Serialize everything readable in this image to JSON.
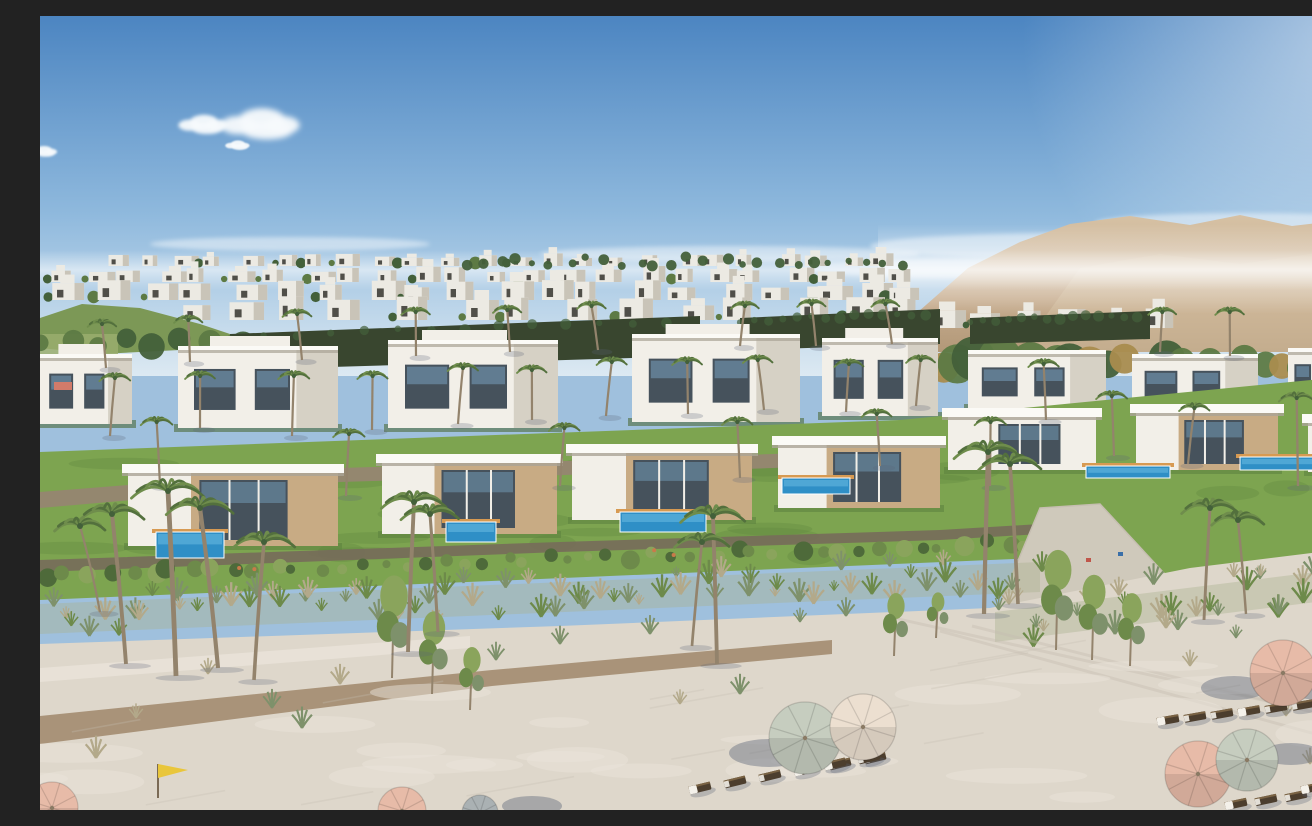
{
  "meta": {
    "description": "Aerial architectural rendering of a beachfront resort community: terraced rows of modern white villas with private blue pools and palm trees, desert mountains on the right horizon, a dune grass strip, and a wide sandy beach with pink and sage umbrellas, wooden sun loungers and a yellow beach flag.",
    "width": 1312,
    "height": 794
  },
  "palette": {
    "skyTop": "#4c85c1",
    "skyMid": "#8fb9dd",
    "skyHorizon": "#dce9f2",
    "cloud": "#f7fafc",
    "mountain": "#c8ae90",
    "mountainShade": "#b29878",
    "mountainLight": "#d6c1a4",
    "hillGreen": "#7c9856",
    "fieldGreen": "#9aad6d",
    "houseLight": "#eceae3",
    "houseShade": "#c9c4b8",
    "houseWindow": "#504f49",
    "treeGreen": "#5d7a44",
    "treeDark": "#43603a",
    "treeAutumn": "#a98c4e",
    "hedgeDark": "#39462f",
    "villaWhite": "#f2efe8",
    "villaShade": "#d6d1c5",
    "roofWhite": "#fbfaf6",
    "roofShadow": "#aaa496",
    "wood": "#c8ab84",
    "glass": "#46525c",
    "glassBlue": "#7ba6c6",
    "poolBlue": "#2f8fc6",
    "poolLight": "#5db0dc",
    "deckOrange": "#d79a52",
    "lawn": "#7da450",
    "lawnDark": "#5d8440",
    "shrub": "#4e6a3a",
    "shrubLight": "#6d8a4a",
    "shrubPale": "#8aa45c",
    "flower": "#c97a4a",
    "stone": "#94876f",
    "stoneDark": "#776c5a",
    "concrete": "#cfc9bb",
    "sand": "#ded7cb",
    "sandLight": "#eae4da",
    "sandShade": "#c6beb1",
    "dirt": "#a28a6d",
    "duneSage": "#a9b18e",
    "tuftGreen": "#7e916b",
    "tuftDry": "#b3a98a",
    "palmTrunk": "#93836c",
    "palmFrond": "#53703d",
    "palmFrondLight": "#6f8d4c",
    "umbrellaPink": "#e7bba8",
    "umbrellaCream": "#ecdfd0",
    "umbrellaSage": "#c6cdbf",
    "umbrellaGray": "#aab1b3",
    "shadowBlue": "#5a6478",
    "loungerDark": "#4c3e2e",
    "loungerFrame": "#7a6344",
    "towelWhite": "#f4f1ea",
    "flagYellow": "#e9c63b"
  },
  "sky": {
    "clouds": [
      {
        "x": 164,
        "y": 106,
        "s": 0.8
      },
      {
        "x": 222,
        "y": 104,
        "s": 1.3
      },
      {
        "x": 198,
        "y": 128,
        "s": 0.4
      },
      {
        "x": 4,
        "y": 134,
        "s": 0.45
      }
    ],
    "wisps": [
      {
        "x": 250,
        "y": 228,
        "rx": 140,
        "ry": 7
      },
      {
        "x": 690,
        "y": 238,
        "rx": 190,
        "ry": 8
      },
      {
        "x": 1040,
        "y": 230,
        "rx": 210,
        "ry": 13
      },
      {
        "x": 1205,
        "y": 207,
        "rx": 150,
        "ry": 10
      },
      {
        "x": 930,
        "y": 252,
        "rx": 170,
        "ry": 10
      }
    ]
  },
  "mountains": {
    "main": [
      [
        838,
        336
      ],
      [
        878,
        296
      ],
      [
        928,
        252
      ],
      [
        980,
        226
      ],
      [
        1030,
        208
      ],
      [
        1090,
        200
      ],
      [
        1150,
        209
      ],
      [
        1200,
        199
      ],
      [
        1252,
        210
      ],
      [
        1312,
        203
      ],
      [
        1312,
        336
      ]
    ],
    "front": [
      [
        980,
        336
      ],
      [
        1040,
        252
      ],
      [
        1120,
        238
      ],
      [
        1200,
        248
      ],
      [
        1312,
        232
      ],
      [
        1312,
        336
      ]
    ]
  },
  "farHills": {
    "green": [
      [
        0,
        302
      ],
      [
        42,
        288
      ],
      [
        100,
        292
      ],
      [
        160,
        308
      ],
      [
        202,
        322
      ],
      [
        140,
        334
      ],
      [
        60,
        338
      ],
      [
        0,
        332
      ]
    ],
    "field": {
      "x": 0,
      "y": 318,
      "w": 78,
      "h": 44
    }
  },
  "distantRows": [
    {
      "y": 250,
      "x0": 60,
      "x1": 860,
      "n": 24,
      "wMin": 14,
      "wMax": 26,
      "hMin": 8,
      "hMax": 13,
      "treeProb": 0.45,
      "seed": 11
    },
    {
      "y": 266,
      "x0": 0,
      "x1": 880,
      "n": 24,
      "wMin": 16,
      "wMax": 30,
      "hMin": 10,
      "hMax": 16,
      "treeProb": 0.4,
      "seed": 22
    },
    {
      "y": 284,
      "x0": 0,
      "x1": 890,
      "n": 20,
      "wMin": 20,
      "wMax": 36,
      "hMin": 12,
      "hMax": 20,
      "treeProb": 0.4,
      "seed": 33
    },
    {
      "y": 304,
      "x0": 120,
      "x1": 900,
      "n": 14,
      "wMin": 24,
      "wMax": 44,
      "hMin": 14,
      "hMax": 24,
      "treeProb": 0.5,
      "seed": 44
    },
    {
      "y": 312,
      "x0": 880,
      "x1": 1150,
      "n": 6,
      "wMin": 22,
      "wMax": 38,
      "hMin": 12,
      "hMax": 20,
      "treeProb": 0.6,
      "seed": 55
    }
  ],
  "treelines": [
    {
      "y": 250,
      "x0": 420,
      "x1": 870,
      "n": 26,
      "rMin": 3,
      "rMax": 6,
      "seed": 5,
      "color": "treeDark",
      "autumn": 0
    },
    {
      "y": 352,
      "x0": 855,
      "x1": 1312,
      "n": 24,
      "rMin": 11,
      "rMax": 22,
      "seed": 6,
      "color": "treeGreen",
      "autumn": 0.25
    },
    {
      "y": 332,
      "x0": 0,
      "x1": 215,
      "n": 8,
      "rMin": 8,
      "rMax": 14,
      "seed": 7,
      "color": "treeGreen",
      "autumn": 0
    }
  ],
  "hedges": [
    {
      "pts": [
        [
          190,
          318
        ],
        [
          660,
          300
        ],
        [
          660,
          340
        ],
        [
          190,
          354
        ]
      ]
    },
    {
      "pts": [
        [
          700,
          302
        ],
        [
          900,
          293
        ],
        [
          900,
          328
        ],
        [
          700,
          334
        ]
      ]
    },
    {
      "pts": [
        [
          930,
          302
        ],
        [
          1110,
          295
        ],
        [
          1110,
          323
        ],
        [
          930,
          328
        ]
      ]
    }
  ],
  "backVillas": [
    {
      "x": 0,
      "y": 338,
      "w": 92,
      "h": 70,
      "two": true
    },
    {
      "x": 138,
      "y": 330,
      "w": 160,
      "h": 82,
      "two": true
    },
    {
      "x": 348,
      "y": 324,
      "w": 170,
      "h": 88,
      "two": true
    },
    {
      "x": 592,
      "y": 318,
      "w": 168,
      "h": 88,
      "two": true
    },
    {
      "x": 782,
      "y": 322,
      "w": 116,
      "h": 78,
      "two": true
    },
    {
      "x": 928,
      "y": 334,
      "w": 138,
      "h": 58,
      "two": false
    },
    {
      "x": 1092,
      "y": 338,
      "w": 126,
      "h": 56,
      "two": false
    },
    {
      "x": 1248,
      "y": 332,
      "w": 64,
      "h": 54,
      "two": false
    }
  ],
  "lawn": {
    "main": [
      [
        0,
        436
      ],
      [
        860,
        404
      ],
      [
        1312,
        360
      ],
      [
        1312,
        548
      ],
      [
        1150,
        564
      ],
      [
        1046,
        540
      ],
      [
        0,
        584
      ]
    ],
    "wall1": [
      [
        0,
        476
      ],
      [
        300,
        452
      ],
      [
        620,
        442
      ],
      [
        900,
        432
      ],
      [
        900,
        446
      ],
      [
        620,
        456
      ],
      [
        300,
        466
      ],
      [
        0,
        492
      ]
    ],
    "wall2": [
      [
        0,
        544
      ],
      [
        520,
        526
      ],
      [
        900,
        514
      ],
      [
        1000,
        508
      ],
      [
        1000,
        518
      ],
      [
        900,
        524
      ],
      [
        520,
        536
      ],
      [
        0,
        556
      ]
    ]
  },
  "frontVillas": [
    {
      "x": 88,
      "y": 448,
      "w": 210,
      "h": 82,
      "wood": true
    },
    {
      "x": 342,
      "y": 438,
      "w": 175,
      "h": 80,
      "wood": true
    },
    {
      "x": 532,
      "y": 428,
      "w": 180,
      "h": 76,
      "wood": true
    },
    {
      "x": 738,
      "y": 420,
      "w": 162,
      "h": 72,
      "wood": true
    },
    {
      "x": 908,
      "y": 392,
      "w": 148,
      "h": 62,
      "wood": false
    },
    {
      "x": 1096,
      "y": 388,
      "w": 142,
      "h": 66,
      "wood": true
    },
    {
      "x": 1268,
      "y": 398,
      "w": 44,
      "h": 58,
      "wood": false
    }
  ],
  "pools": [
    {
      "x": 116,
      "y": 516,
      "w": 68,
      "h": 26
    },
    {
      "x": 406,
      "y": 506,
      "w": 50,
      "h": 20
    },
    {
      "x": 580,
      "y": 496,
      "w": 86,
      "h": 20
    },
    {
      "x": 742,
      "y": 462,
      "w": 68,
      "h": 16
    },
    {
      "x": 1046,
      "y": 450,
      "w": 84,
      "h": 12
    },
    {
      "x": 1200,
      "y": 441,
      "w": 96,
      "h": 13
    }
  ],
  "ramp": [
    [
      1000,
      492
    ],
    [
      1060,
      488
    ],
    [
      1160,
      596
    ],
    [
      1010,
      628
    ],
    [
      950,
      612
    ]
  ],
  "rampMarkers": [
    {
      "x": 1046,
      "y": 542,
      "c": "#c0564a"
    },
    {
      "x": 1078,
      "y": 536,
      "c": "#3a6fa8"
    }
  ],
  "sand": {
    "base": [
      [
        0,
        628
      ],
      [
        520,
        610
      ],
      [
        950,
        592
      ],
      [
        1150,
        552
      ],
      [
        1312,
        532
      ],
      [
        1312,
        794
      ],
      [
        0,
        794
      ]
    ],
    "lightPath": [
      [
        0,
        652
      ],
      [
        430,
        620
      ],
      [
        430,
        632
      ],
      [
        0,
        666
      ]
    ],
    "dirtPath": [
      [
        0,
        700
      ],
      [
        452,
        654
      ],
      [
        792,
        624
      ],
      [
        792,
        638
      ],
      [
        452,
        670
      ],
      [
        0,
        728
      ]
    ],
    "tracks": [
      [
        [
          900,
          615
        ],
        [
          1312,
          728
        ]
      ],
      [
        [
          932,
          610
        ],
        [
          1312,
          706
        ]
      ],
      [
        [
          845,
          600
        ],
        [
          1240,
          688
        ]
      ]
    ],
    "textureSeed": 99,
    "duneSeedLeft": 71,
    "duneSeedRight": 72
  },
  "shrubBand": {
    "x0": 0,
    "y0": 560,
    "x1": 1000,
    "y1": 526,
    "n": 48,
    "seed": 61
  },
  "duneBandLeft": {
    "x0": 0,
    "y0": 604,
    "x1": 1000,
    "y1": 562,
    "n": 72,
    "spread": 20
  },
  "duneBandRight": {
    "x0": 955,
    "y0": 612,
    "x1": 1308,
    "y1": 568,
    "n": 30,
    "spread": 26
  },
  "beachTrees": [
    {
      "x": 352,
      "y": 662,
      "h": 86
    },
    {
      "x": 392,
      "y": 678,
      "h": 70
    },
    {
      "x": 430,
      "y": 694,
      "h": 54
    },
    {
      "x": 854,
      "y": 640,
      "h": 54
    },
    {
      "x": 896,
      "y": 622,
      "h": 40
    },
    {
      "x": 1016,
      "y": 634,
      "h": 84
    },
    {
      "x": 1052,
      "y": 644,
      "h": 72
    },
    {
      "x": 1090,
      "y": 650,
      "h": 62
    }
  ],
  "beachTufts": [
    {
      "x": 96,
      "y": 702
    },
    {
      "x": 168,
      "y": 658
    },
    {
      "x": 232,
      "y": 692
    },
    {
      "x": 262,
      "y": 712
    },
    {
      "x": 456,
      "y": 644
    },
    {
      "x": 520,
      "y": 628
    },
    {
      "x": 610,
      "y": 618
    },
    {
      "x": 640,
      "y": 688
    },
    {
      "x": 700,
      "y": 678
    },
    {
      "x": 760,
      "y": 606
    },
    {
      "x": 806,
      "y": 600
    },
    {
      "x": 1126,
      "y": 612
    },
    {
      "x": 1196,
      "y": 622
    },
    {
      "x": 1286,
      "y": 742
    },
    {
      "x": 1270,
      "y": 748
    },
    {
      "x": 1246,
      "y": 700
    },
    {
      "x": 1150,
      "y": 650
    },
    {
      "x": 56,
      "y": 742
    },
    {
      "x": 300,
      "y": 668
    }
  ],
  "beachPalms": [
    {
      "x": 86,
      "y": 648,
      "h": 150,
      "lean": -14
    },
    {
      "x": 136,
      "y": 660,
      "h": 185,
      "lean": -8
    },
    {
      "x": 178,
      "y": 652,
      "h": 160,
      "lean": -18
    },
    {
      "x": 214,
      "y": 664,
      "h": 138,
      "lean": 10
    },
    {
      "x": 60,
      "y": 596,
      "h": 86,
      "lean": -20
    },
    {
      "x": 368,
      "y": 636,
      "h": 150,
      "lean": 6
    },
    {
      "x": 398,
      "y": 616,
      "h": 118,
      "lean": -8
    },
    {
      "x": 677,
      "y": 648,
      "h": 148,
      "lean": -4
    },
    {
      "x": 652,
      "y": 630,
      "h": 104,
      "lean": 10
    },
    {
      "x": 944,
      "y": 598,
      "h": 162,
      "lean": 4
    },
    {
      "x": 978,
      "y": 588,
      "h": 140,
      "lean": -8
    },
    {
      "x": 1164,
      "y": 604,
      "h": 112,
      "lean": 6
    },
    {
      "x": 1206,
      "y": 598,
      "h": 94,
      "lean": -8
    }
  ],
  "midPalms": [
    {
      "x": 70,
      "y": 420,
      "h": 58
    },
    {
      "x": 160,
      "y": 412,
      "h": 52
    },
    {
      "x": 252,
      "y": 420,
      "h": 60
    },
    {
      "x": 332,
      "y": 414,
      "h": 54
    },
    {
      "x": 418,
      "y": 408,
      "h": 56
    },
    {
      "x": 492,
      "y": 404,
      "h": 50
    },
    {
      "x": 566,
      "y": 400,
      "h": 54
    },
    {
      "x": 648,
      "y": 398,
      "h": 52
    },
    {
      "x": 724,
      "y": 394,
      "h": 50
    },
    {
      "x": 806,
      "y": 396,
      "h": 48
    },
    {
      "x": 876,
      "y": 390,
      "h": 46
    },
    {
      "x": 1006,
      "y": 404,
      "h": 56
    },
    {
      "x": 1074,
      "y": 440,
      "h": 60
    },
    {
      "x": 1148,
      "y": 448,
      "h": 56
    },
    {
      "x": 1258,
      "y": 470,
      "h": 88
    },
    {
      "x": 1298,
      "y": 430,
      "h": 60
    },
    {
      "x": 120,
      "y": 470,
      "h": 64
    },
    {
      "x": 306,
      "y": 480,
      "h": 62
    },
    {
      "x": 520,
      "y": 470,
      "h": 58
    },
    {
      "x": 700,
      "y": 462,
      "h": 56
    },
    {
      "x": 840,
      "y": 450,
      "h": 52
    },
    {
      "x": 950,
      "y": 470,
      "h": 64
    },
    {
      "x": 66,
      "y": 352,
      "h": 44
    },
    {
      "x": 150,
      "y": 346,
      "h": 42
    },
    {
      "x": 262,
      "y": 344,
      "h": 46
    },
    {
      "x": 376,
      "y": 340,
      "h": 44
    },
    {
      "x": 470,
      "y": 336,
      "h": 42
    },
    {
      "x": 558,
      "y": 334,
      "h": 44
    },
    {
      "x": 700,
      "y": 330,
      "h": 40
    },
    {
      "x": 776,
      "y": 330,
      "h": 42
    },
    {
      "x": 852,
      "y": 328,
      "h": 40
    },
    {
      "x": 1120,
      "y": 336,
      "h": 40
    },
    {
      "x": 1190,
      "y": 340,
      "h": 44
    }
  ],
  "umbrellas": [
    {
      "x": 765,
      "y": 722,
      "r": 36,
      "c": "sage"
    },
    {
      "x": 823,
      "y": 711,
      "r": 33,
      "c": "cream"
    },
    {
      "x": 1243,
      "y": 657,
      "r": 33,
      "c": "pink"
    },
    {
      "x": 1158,
      "y": 758,
      "r": 33,
      "c": "pink"
    },
    {
      "x": 1207,
      "y": 744,
      "r": 31,
      "c": "sage"
    },
    {
      "x": 1302,
      "y": 728,
      "r": 26,
      "c": "pink"
    },
    {
      "x": 12,
      "y": 792,
      "r": 26,
      "c": "pink"
    },
    {
      "x": 362,
      "y": 795,
      "r": 24,
      "c": "pink"
    },
    {
      "x": 440,
      "y": 797,
      "r": 18,
      "c": "gray"
    }
  ],
  "umbrellaShadows": [
    {
      "x": 729,
      "y": 737,
      "rx": 40,
      "ry": 14
    },
    {
      "x": 1281,
      "y": 671,
      "rx": 36,
      "ry": 13
    },
    {
      "x": 1194,
      "y": 672,
      "rx": 33,
      "ry": 12
    },
    {
      "x": 1251,
      "y": 738,
      "rx": 30,
      "ry": 11
    },
    {
      "x": 492,
      "y": 790,
      "rx": 30,
      "ry": 10
    }
  ],
  "loungerRows": [
    {
      "x": 660,
      "y": 772,
      "dx": 35,
      "dy": -6,
      "n": 6,
      "a": -14
    },
    {
      "x": 795,
      "y": 748,
      "dx": 34,
      "dy": -6,
      "n": 2,
      "a": -14
    },
    {
      "x": 1128,
      "y": 704,
      "dx": 27,
      "dy": -3,
      "n": 6,
      "a": -10
    },
    {
      "x": 1196,
      "y": 788,
      "dx": 30,
      "dy": -4,
      "n": 4,
      "a": -12
    },
    {
      "x": 1272,
      "y": 772,
      "dx": 26,
      "dy": -4,
      "n": 2,
      "a": -12
    }
  ],
  "flag": {
    "x": 118,
    "y": 748,
    "h": 34
  },
  "coralAccent": {
    "x": 14,
    "y": 366,
    "w": 18,
    "h": 8
  }
}
